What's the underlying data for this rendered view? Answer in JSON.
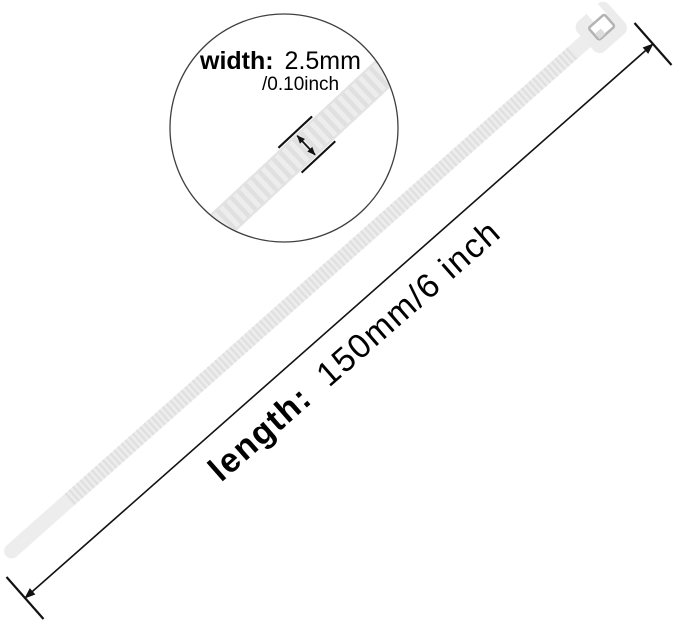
{
  "page": {
    "background": "#ffffff",
    "description": "Product dimension diagram of a white nylon cable tie (zip tie)"
  },
  "colors": {
    "tie_fill": "#ededed",
    "tie_rib": "#e0e0e0",
    "head_fill": "#ececec",
    "slot_stroke": "#b3b3b3",
    "pawl_fill": "#dcdcdc",
    "dimension_line": "#121212",
    "circle_stroke": "#3f3f3f",
    "text": "#000000"
  },
  "inset": {
    "width_label": "width:",
    "width_value": "2.5mm",
    "width_alt_value": "/0.10inch"
  },
  "length_dimension": {
    "label": "length:",
    "value": "150mm/6 inch"
  }
}
